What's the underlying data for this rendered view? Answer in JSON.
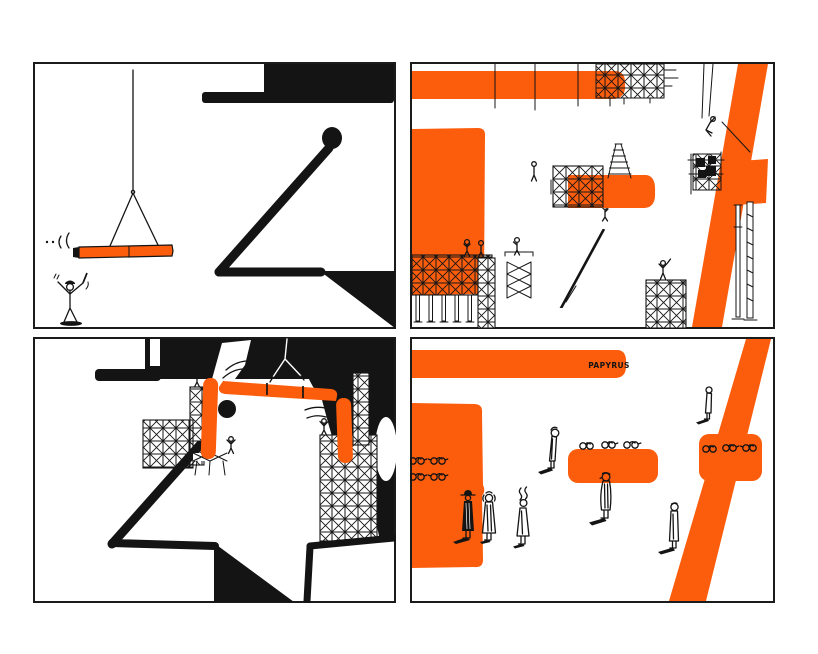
{
  "colors": {
    "orange": "#FB5D0D",
    "ink": "#141414",
    "paper": "#ffffff",
    "border": "#1b1b1b"
  },
  "comic": {
    "panel_count": 4,
    "sign_text": "PAPYRUS"
  }
}
